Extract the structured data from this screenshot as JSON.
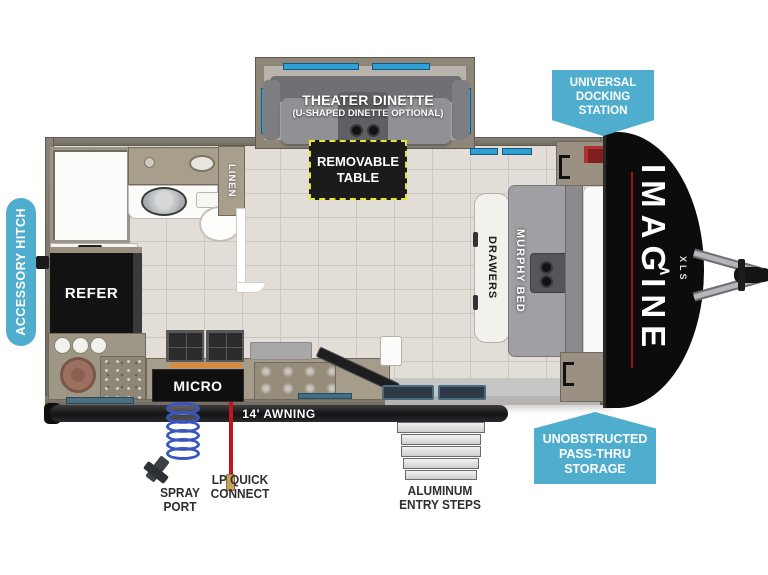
{
  "colors": {
    "badge_blue": "#4fadce",
    "table_border_yellow": "#e8e531",
    "brand_red": "#a6101c",
    "window_blue": "#2f9fd6",
    "wall_taupe": "#8a8376"
  },
  "badges": {
    "accessory_hitch": "ACCESSORY HITCH",
    "docking_station": "UNIVERSAL\nDOCKING\nSTATION",
    "passthru_storage": "UNOBSTRUCTED\nPASS-THRU\nSTORAGE"
  },
  "rooms": {
    "dinette_title": "THEATER DINETTE",
    "dinette_subtitle": "(U-SHAPED DINETTE OPTIONAL)",
    "removable_table": "REMOVABLE\nTABLE",
    "linen": "LINEN",
    "refrigerator": "REFER",
    "microwave": "MICRO",
    "drawers": "DRAWERS",
    "murphy_bed": "MURPHY BED"
  },
  "exterior": {
    "awning": "14' AWNING",
    "brand": "IMAGINE",
    "brand_model": "XLS",
    "brand_chevron": "∧",
    "spray_port": "SPRAY\nPORT",
    "lp_quick_connect": "LP QUICK\nCONNECT",
    "entry_steps": "ALUMINUM\nENTRY STEPS"
  }
}
